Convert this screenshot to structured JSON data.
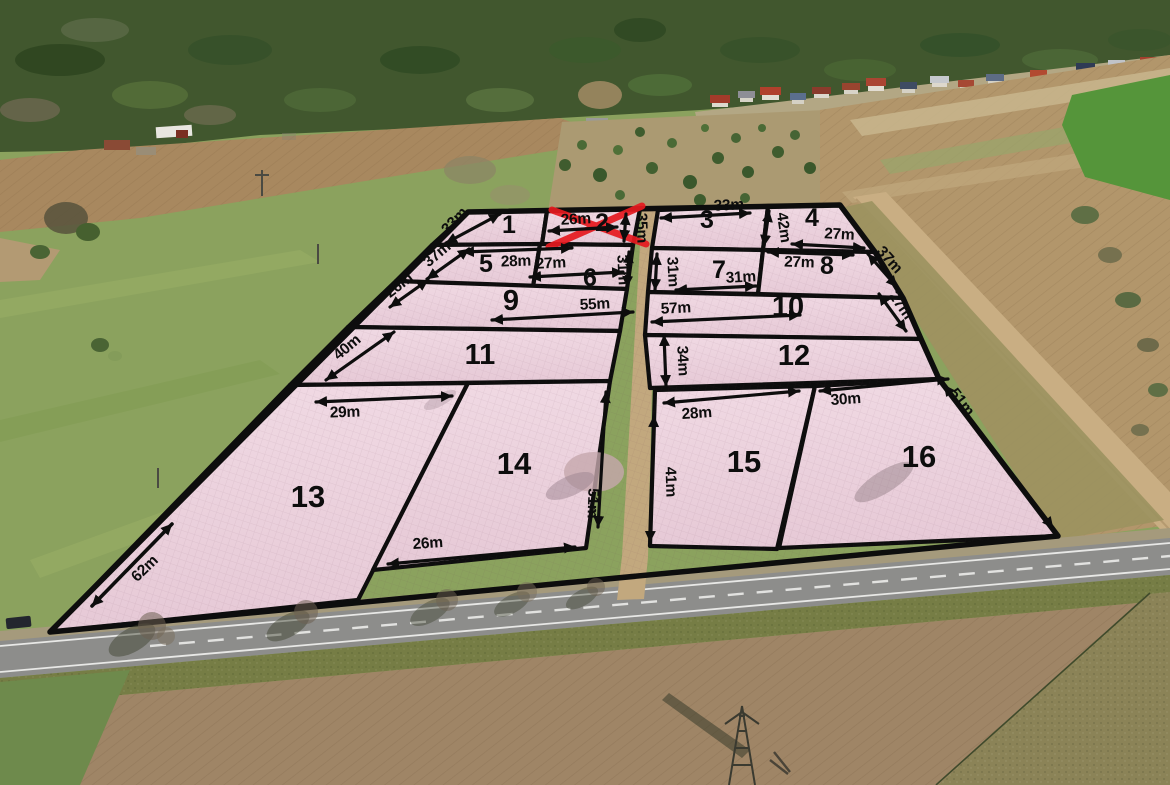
{
  "scene": {
    "type": "aerial-photo-land-plot-map",
    "colors": {
      "plot_fill": "#ecd3df",
      "boundary": "#0d0d0d",
      "sold_marker": "#e6191f",
      "label_text": "#0d0d0d"
    }
  },
  "plots": [
    {
      "n": "1",
      "sold": false
    },
    {
      "n": "2",
      "sold": true
    },
    {
      "n": "3",
      "sold": false
    },
    {
      "n": "4",
      "sold": false
    },
    {
      "n": "5",
      "sold": false
    },
    {
      "n": "6",
      "sold": false
    },
    {
      "n": "7",
      "sold": false
    },
    {
      "n": "8",
      "sold": false
    },
    {
      "n": "9",
      "sold": false
    },
    {
      "n": "10",
      "sold": false
    },
    {
      "n": "11",
      "sold": false
    },
    {
      "n": "12",
      "sold": false
    },
    {
      "n": "13",
      "sold": false
    },
    {
      "n": "14",
      "sold": false
    },
    {
      "n": "15",
      "sold": false
    },
    {
      "n": "16",
      "sold": false
    }
  ],
  "dims": {
    "d1": "33m",
    "d2": "26m",
    "d3": "35m",
    "d4": "33m",
    "d5": "42m",
    "d6": "27m",
    "d7": "37m",
    "d8": "28m",
    "d9": "27m",
    "d10": "31m",
    "d11": "31m",
    "d12": "31m",
    "d13": "27m",
    "d14": "37m",
    "d15": "26m",
    "d16": "55m",
    "d17": "57m",
    "d18": "27m",
    "d19": "40m",
    "d20": "34m",
    "d21": "29m",
    "d22": "51m",
    "d23": "26m",
    "d24": "28m",
    "d25": "41m",
    "d26": "30m",
    "d27": "51m",
    "d28": "62m"
  }
}
